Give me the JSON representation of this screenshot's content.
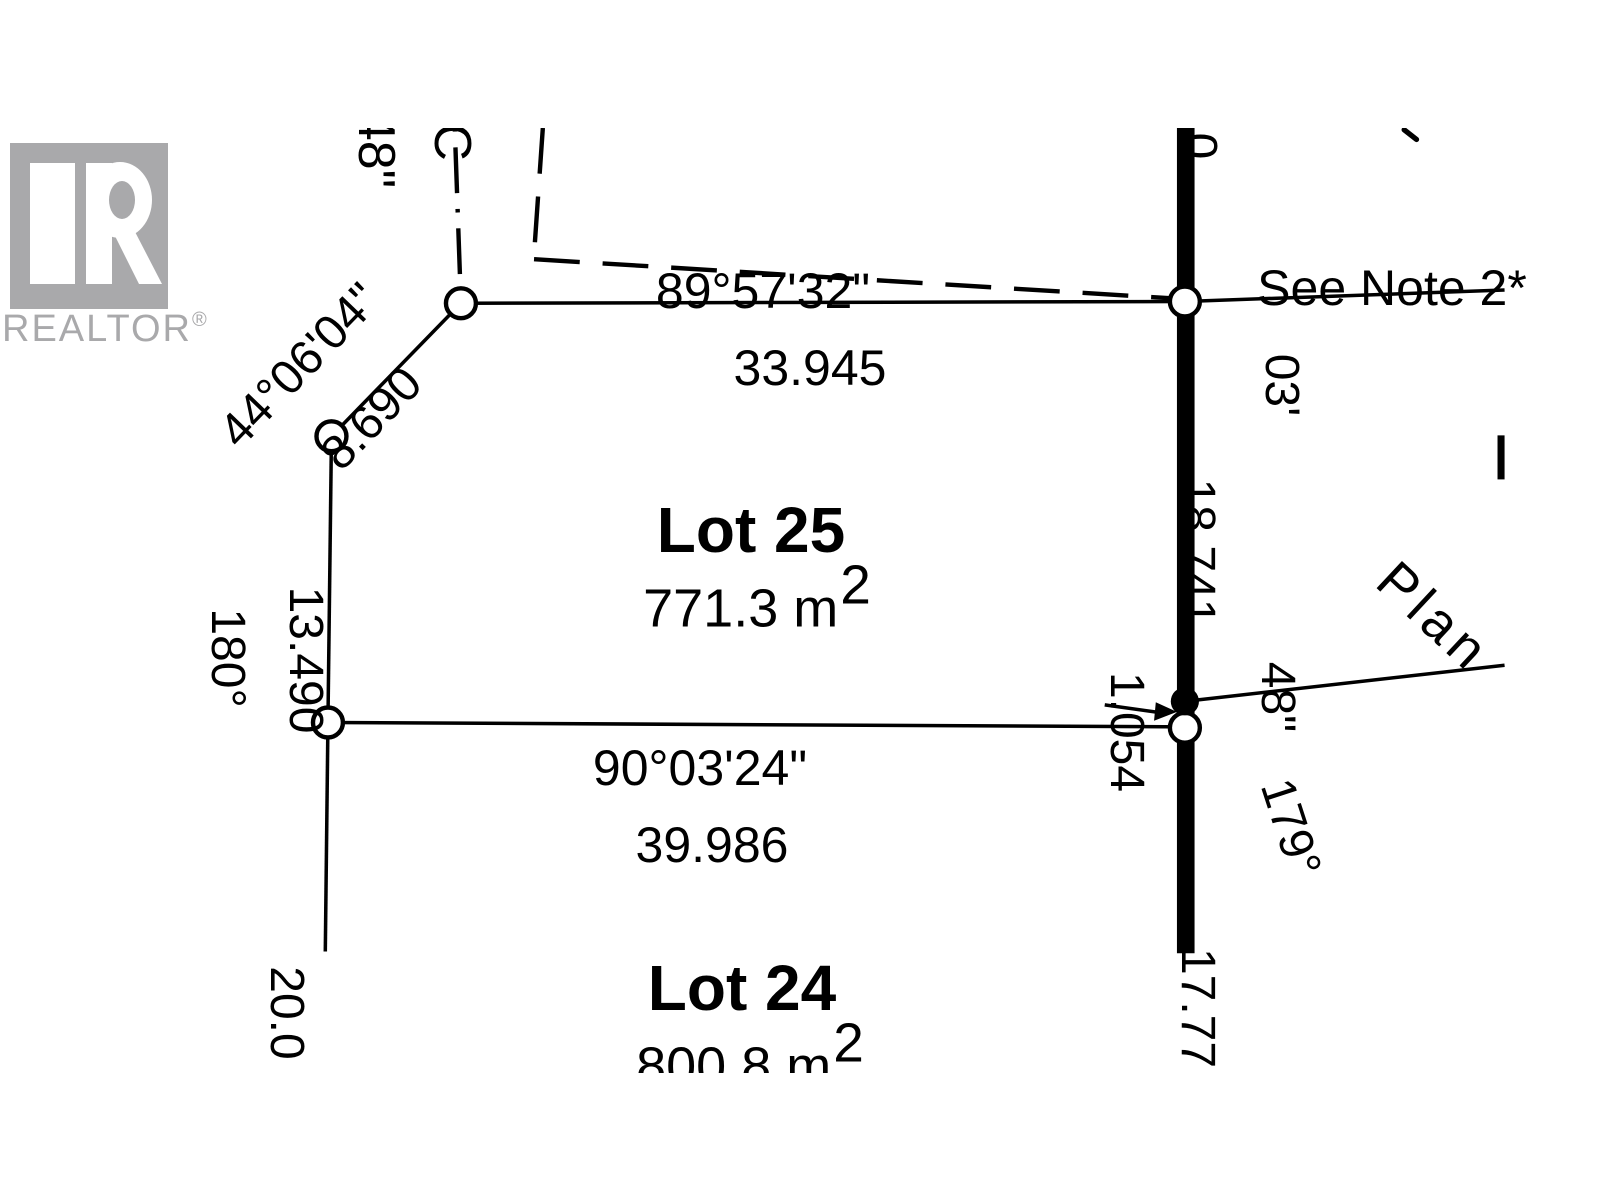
{
  "background_color": "#ffffff",
  "line_color": "#000000",
  "logo": {
    "brand": "REALTOR",
    "registered_mark": "®",
    "color": "#a9a9ab"
  },
  "lots": {
    "lot25": {
      "name": "Lot 25",
      "area_value": "771.3 m",
      "area_exponent": "2"
    },
    "lot24": {
      "name": "Lot 24",
      "area_value": "800.8 m",
      "area_exponent": "2"
    }
  },
  "boundaries": {
    "north": {
      "bearing": "89°57'32\"",
      "distance": "33.945"
    },
    "south": {
      "bearing": "90°03'24\"",
      "distance": "39.986"
    },
    "west": {
      "angle": "180°",
      "distance": "13.490"
    },
    "west_lower": {
      "distance": "20.0"
    },
    "northwest": {
      "bearing": "44°06'04\"",
      "distance": "8.690"
    }
  },
  "road": {
    "partial_top_digit": "0",
    "minutes": "03'",
    "distance_upper": "18.741",
    "seconds": "48\"",
    "offset": "1.054",
    "angle": "179°",
    "distance_lower": "17.77"
  },
  "annotations": {
    "note": "See Note 2*",
    "plan": "Plan",
    "top_seconds": "48\"",
    "top_partial_letter": "C"
  }
}
